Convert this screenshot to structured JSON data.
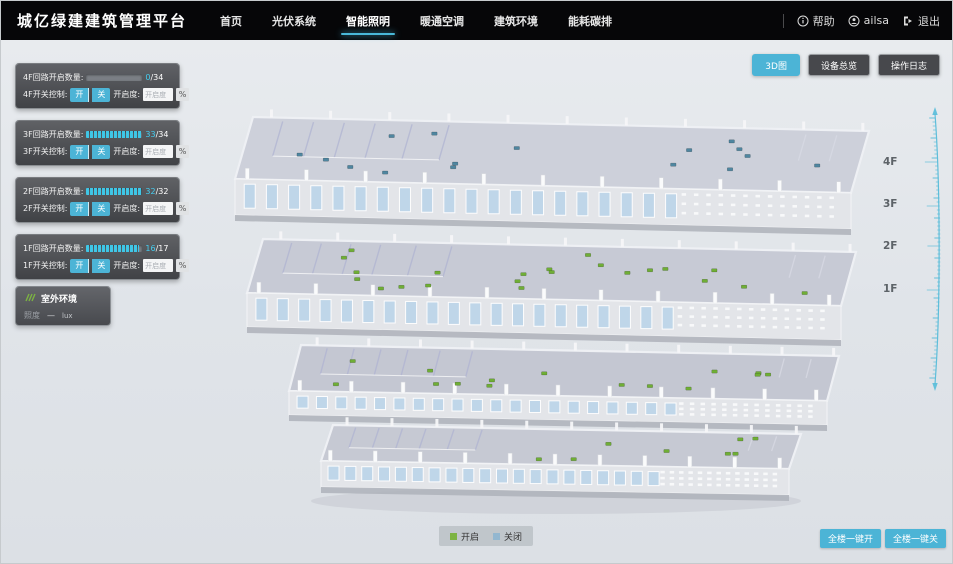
{
  "header": {
    "title": "城亿绿建建筑管理平台",
    "nav": {
      "items": [
        {
          "label": "首页",
          "active": false
        },
        {
          "label": "光伏系统",
          "active": false
        },
        {
          "label": "智能照明",
          "active": true
        },
        {
          "label": "暖通空调",
          "active": false
        },
        {
          "label": "建筑环境",
          "active": false
        },
        {
          "label": "能耗碳排",
          "active": false
        }
      ]
    },
    "user": {
      "help_label": "帮助",
      "username": "ailsa",
      "logout_label": "退出"
    }
  },
  "view_buttons": [
    {
      "label": "3D图",
      "active": true
    },
    {
      "label": "设备总览",
      "active": false
    },
    {
      "label": "操作日志",
      "active": false
    }
  ],
  "floors": [
    {
      "id": "4F",
      "circuit_label": "4F回路开启数量:",
      "open": 0,
      "total": 34,
      "total_text": "/34",
      "switch_label": "4F开关控制:",
      "on_label": "开",
      "off_label": "关",
      "dim_label": "开启度:",
      "dim_placeholder": "开启度",
      "percent_label": "%"
    },
    {
      "id": "3F",
      "circuit_label": "3F回路开启数量:",
      "open": 33,
      "total": 34,
      "total_text": "/34",
      "switch_label": "3F开关控制:",
      "on_label": "开",
      "off_label": "关",
      "dim_label": "开启度:",
      "dim_placeholder": "开启度",
      "percent_label": "%"
    },
    {
      "id": "2F",
      "circuit_label": "2F回路开启数量:",
      "open": 32,
      "total": 32,
      "total_text": "/32",
      "switch_label": "2F开关控制:",
      "on_label": "开",
      "off_label": "关",
      "dim_label": "开启度:",
      "dim_placeholder": "开启度",
      "percent_label": "%"
    },
    {
      "id": "1F",
      "circuit_label": "1F回路开启数量:",
      "open": 16,
      "total": 17,
      "total_text": "/17",
      "switch_label": "1F开关控制:",
      "on_label": "开",
      "off_label": "关",
      "dim_label": "开启度:",
      "dim_placeholder": "开启度",
      "percent_label": "%"
    }
  ],
  "outdoor": {
    "title": "室外环境",
    "illuminance_label": "照度",
    "value": "—",
    "unit": "lux"
  },
  "floor_markers": [
    "4F",
    "3F",
    "2F",
    "1F"
  ],
  "legend": {
    "on": {
      "label": "开启",
      "color": "#7cb342"
    },
    "off": {
      "label": "关闭",
      "color": "#93b7d0"
    }
  },
  "bulk_buttons": [
    {
      "label": "全楼一键开"
    },
    {
      "label": "全楼一键关"
    }
  ],
  "colors": {
    "accent": "#4cb4d6",
    "light_on": "#6fae35",
    "light_off": "#4f86a0"
  },
  "model": {
    "floor_lights": [
      {
        "floor": "4F",
        "state": "off",
        "count": 16
      },
      {
        "floor": "3F",
        "state": "on",
        "count": 22
      },
      {
        "floor": "2F",
        "state": "on",
        "count": 15
      },
      {
        "floor": "1F",
        "state": "on",
        "count": 8
      }
    ]
  }
}
